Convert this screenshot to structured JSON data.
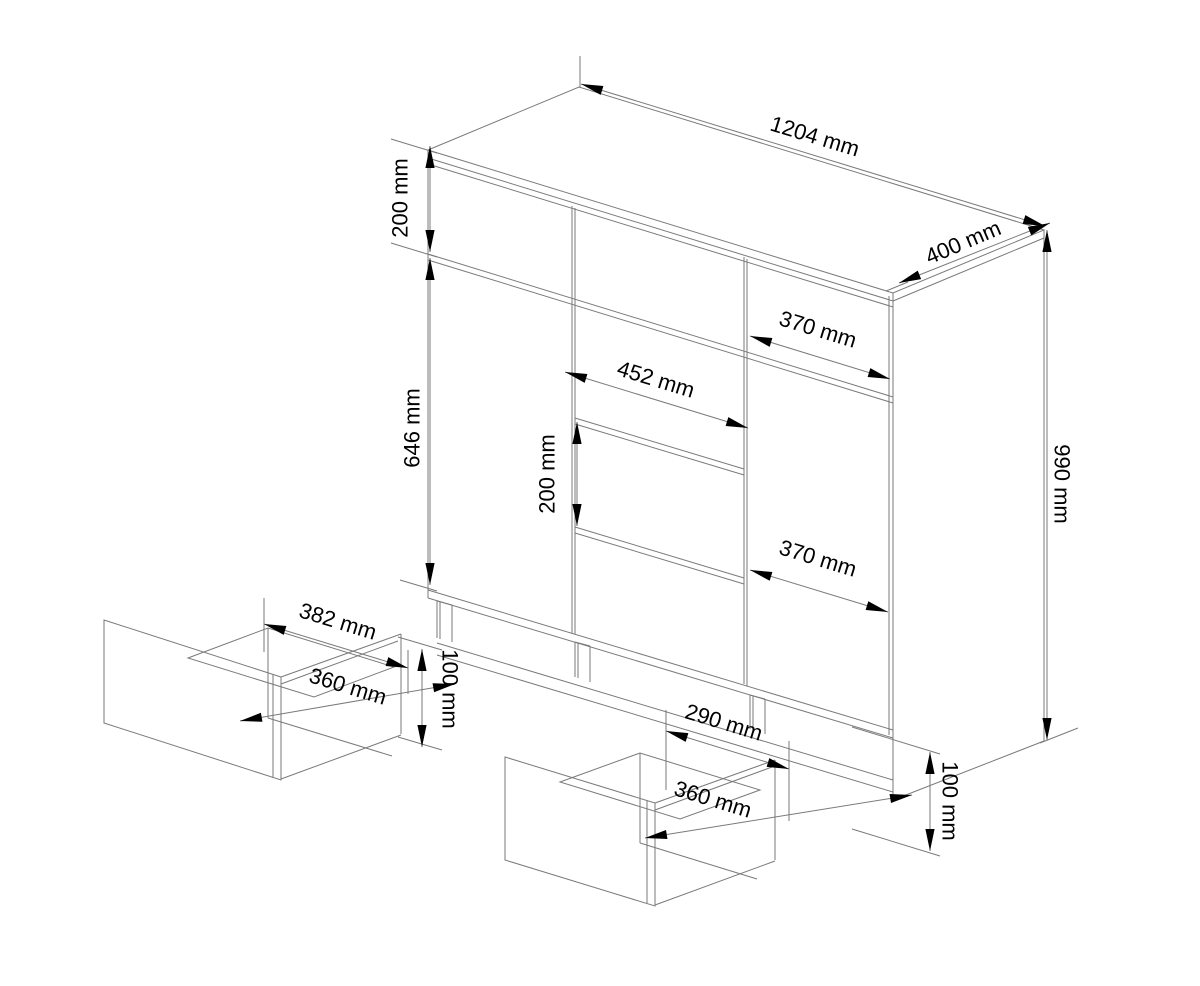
{
  "drawing": {
    "type": "furniture-dimension-diagram",
    "subject": "chest-of-drawers",
    "labels": {
      "total_width": "1204 mm",
      "total_depth": "400 mm",
      "total_height": "990 mm",
      "top_drawer_height": "200 mm",
      "door_height": "646 mm",
      "center_drawer_width": "452 mm",
      "center_drawer_height": "200 mm",
      "right_upper_width": "370 mm",
      "right_lower_width": "370 mm",
      "left_pulled_drawer": {
        "top_width": "382 mm",
        "front_width": "360 mm",
        "height": "100 mm"
      },
      "center_pulled_drawer": {
        "top_width": "290 mm",
        "front_width": "360 mm",
        "height": "100 mm"
      }
    },
    "colors": {
      "line": "#7a7a7a",
      "arrow": "#000000",
      "text": "#000000",
      "background": "#ffffff"
    }
  }
}
